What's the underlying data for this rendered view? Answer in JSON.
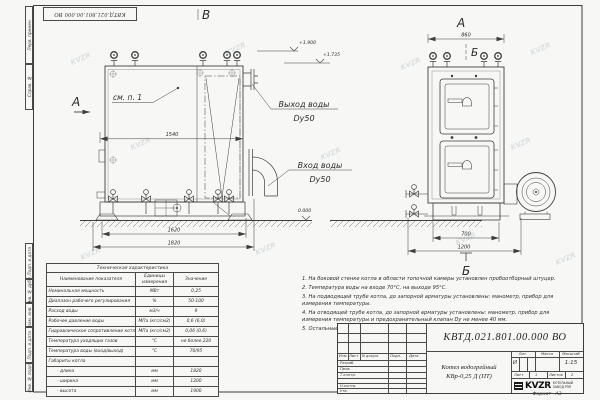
{
  "page": {
    "watermark": "KVZR"
  },
  "margin": {
    "labels": [
      "Перв. примен.",
      "Справ. №",
      "Подп. и дата",
      "Инв. № дубл.",
      "Взам. инв. №",
      "Подп. и дата",
      "Инв. № подл."
    ]
  },
  "drawing": {
    "view_left_label": "В",
    "view_right_label": "А",
    "section_arrow_label": "А",
    "section_b_top": "Б",
    "section_b_bottom": "Б",
    "see_note": "см. п. 1",
    "outlet_line1": "Выход воды",
    "outlet_line2": "Dy50",
    "inlet_line1": "Вход воды",
    "inlet_line2": "Dy50",
    "dim_body_width": "1540",
    "dim_base_width": "1620",
    "dim_total_length": "1820",
    "dim_front_width": "860",
    "dim_front_base": "700",
    "dim_front_total": "1200",
    "elev_top": "+1.900",
    "elev_mid": "+1.735",
    "elev_ground": "0.000"
  },
  "spec_table": {
    "title": "Техническая характеристика",
    "headers": [
      "Наименование показателя",
      "Единицы измерения",
      "Значение"
    ],
    "rows": [
      [
        "Номинальная мощность",
        "МВт",
        "0,25"
      ],
      [
        "Диапазон рабочего регулирования",
        "%",
        "50-100"
      ],
      [
        "Расход воды",
        "м3/ч",
        "9"
      ],
      [
        "Рабочее давление воды",
        "МПа (кгс/см2)",
        "0,6 (6,0)"
      ],
      [
        "Гидравлическое сопротивление котла",
        "МПа (кгс/см2)",
        "0,06 (0,6)"
      ],
      [
        "Температура уходящих газов",
        "°С",
        "не более 220"
      ],
      [
        "Температура воды (вход/выход)",
        "°С",
        "70/95"
      ],
      [
        "Габариты котла",
        "",
        ""
      ],
      [
        "- длина",
        "мм",
        "1820"
      ],
      [
        "- ширина",
        "мм",
        "1200"
      ],
      [
        "- высота",
        "мм",
        "1900"
      ]
    ]
  },
  "notes": [
    "1. На боковой стенке котла в области топочной камеры установлен пробоотборный штуцер.",
    "2. Температура воды на входе 70°С, на выходе 95°С.",
    "3. На подводящей трубе котла, до запорной арматуры установлены: манометр, прибор для измерения температуры.",
    "4. На отводящей трубе котла, до запорной арматуры установлены: манометр, прибор для измерения температуры и предохранительный клапан Dу не менее 40 мм.",
    "5. Остальные технические требования по ОСТ 108.030.133-84."
  ],
  "title_block": {
    "doc_number": "КВТД.021.801.00.000 ВО",
    "product_name": "Котел водогрейный",
    "product_model": "КВр-0,25 Д (ПТ)",
    "header_cols": [
      "Изм.",
      "Лист",
      "N докум.",
      "Подп.",
      "Дата"
    ],
    "row_labels": [
      "Разраб.",
      "Пров.",
      "Т.контр.",
      "Н.контр.",
      "Утв."
    ],
    "lit_label": "Лит.",
    "lit_value": "И",
    "mass_label": "Масса",
    "scale_label": "Масштаб",
    "scale_value": "1:15",
    "sheet_label": "Лист",
    "sheet_value": "1",
    "sheets_label": "Листов",
    "sheets_value": "2",
    "logo": "KVZR",
    "company_line1": "КОТЕЛЬНЫЙ",
    "company_line2": "ЗАВОД РЭП",
    "format_label": "Формат",
    "format_value": "А3"
  }
}
